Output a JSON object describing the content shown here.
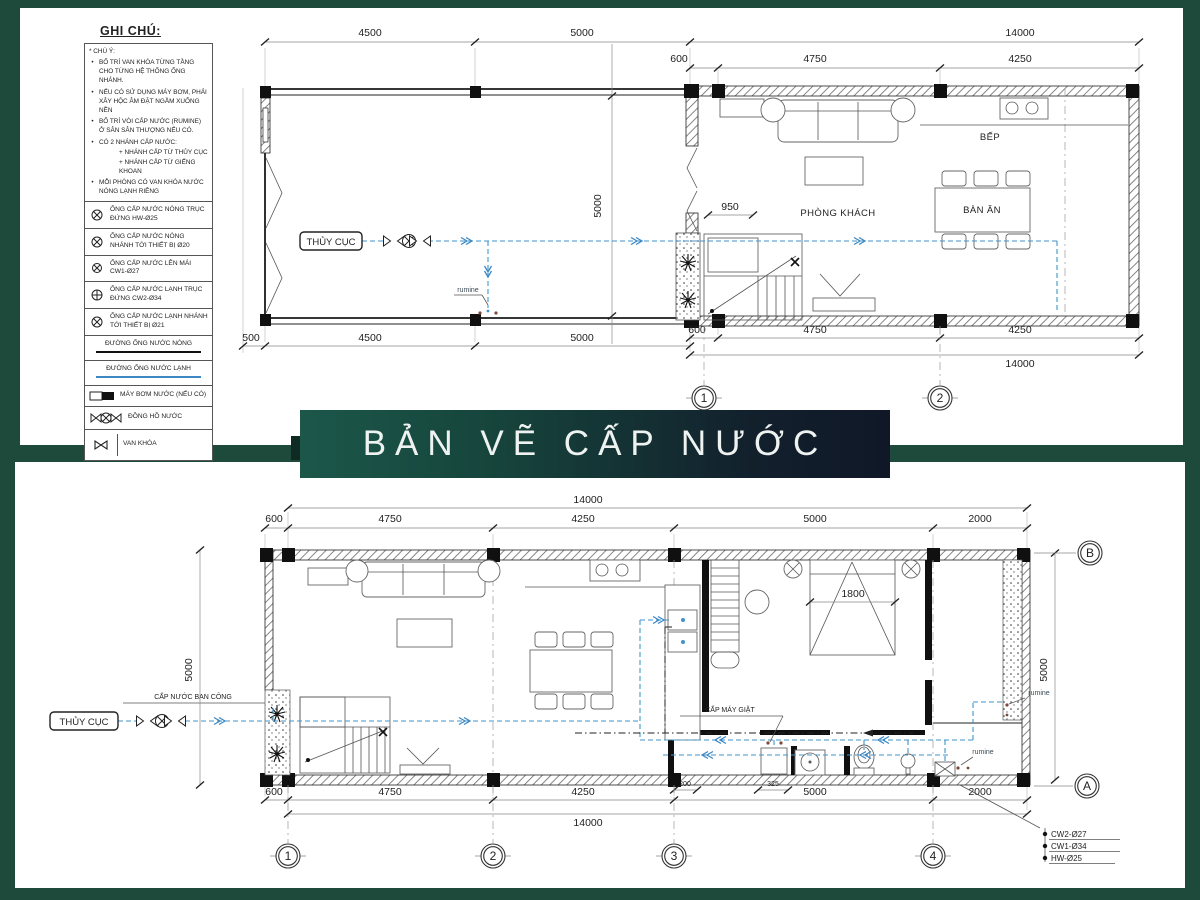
{
  "banner": {
    "title": "BẢN VẼ CẤP NƯỚC"
  },
  "colors": {
    "frame": "#1e4a3b",
    "cold_pipe": "#4093cc",
    "hot_pipe": "#222222",
    "banner_left": "#1c574a",
    "banner_right": "#101827"
  },
  "legend": {
    "title": "GHI CHÚ:",
    "note_header": "* CHÚ Ý:",
    "notes": [
      "BỐ TRÍ VAN KHÓA TỪNG TẦNG CHO TỪNG HỆ THỐNG ỐNG NHÁNH.",
      "NẾU CÓ SỬ DỤNG MÁY BƠM, PHẢI XÂY HỘC ÂM ĐẶT NGẦM XUỐNG NỀN",
      "BỐ TRÍ VÒI CẤP NƯỚC (RUMINE) Ở SÂN SÂN THƯỢNG NẾU CÓ.",
      "CÓ 2 NHÁNH CẤP NƯỚC:",
      "MỖI PHÒNG CÓ VAN KHÓA NƯỚC NÓNG LẠNH RIÊNG"
    ],
    "notes_subs": [
      "+ NHÁNH CẤP TỪ THỦY CỤC",
      "+ NHÁNH CẤP TỪ GIẾNG KHOAN"
    ],
    "items": [
      "ỐNG CẤP NƯỚC NÓNG TRỤC ĐỨNG HW-Ø25",
      "ỐNG CẤP NƯỚC NÓNG NHÁNH TỚI THIẾT BỊ Ø20",
      "ỐNG CẤP NƯỚC LÊN MÁI CW1-Ø27",
      "ỐNG CẤP NƯỚC LẠNH TRỤC ĐỨNG CW2-Ø34",
      "ỐNG CẤP NƯỚC LẠNH NHÁNH TỚI THIẾT BỊ Ø21",
      "ĐƯỜNG ỐNG NƯỚC NÓNG",
      "ĐƯỜNG ỐNG NƯỚC LẠNH",
      "MÁY BƠM NƯỚC (NẾU CÓ)",
      "ĐỒNG HỒ NƯỚC",
      "VAN KHÓA"
    ]
  },
  "top_plan": {
    "dims": {
      "d500": "500",
      "d4500": "4500",
      "d5000": "5000",
      "d14000": "14000",
      "d600": "600",
      "d4750": "4750",
      "d4250": "4250",
      "d950": "950",
      "v5000": "5000"
    },
    "labels": {
      "source": "THỦY CỤC",
      "living": "PHÒNG KHÁCH",
      "kitchen": "BẾP",
      "dining": "BÀN ĂN",
      "rumine": "rumine"
    },
    "grid": {
      "c1": "1",
      "c2": "2"
    }
  },
  "bottom_plan": {
    "dims": {
      "d14000": "14000",
      "d600": "600",
      "d4750": "4750",
      "d4250": "4250",
      "d5000": "5000",
      "d2000": "2000",
      "d200": "200",
      "d325": "325",
      "d1800": "1800",
      "v5000l": "5000",
      "v5000r": "5000"
    },
    "labels": {
      "source": "THỦY CỤC",
      "balcony_supply": "CẤP NƯỚC BAN CÔNG",
      "washer_supply": "CẤP MÁY GIẶT",
      "rumine": "rumine"
    },
    "grid": {
      "c1": "1",
      "c2": "2",
      "c3": "3",
      "c4": "4",
      "rB": "B",
      "rA": "A"
    },
    "pipe_tags": [
      "CW2-Ø27",
      "CW1-Ø34",
      "HW-Ø25"
    ]
  }
}
